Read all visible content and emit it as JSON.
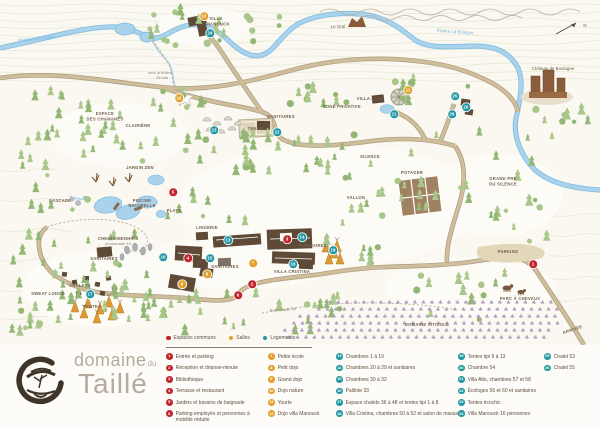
{
  "logo": {
    "name_top": "domaine",
    "name_top_small": "du",
    "name_bottom": "Taillé"
  },
  "colors": {
    "communs": "#c0272d",
    "salles": "#e2a12b",
    "logements": "#2097a3",
    "river": "#a9d3ec",
    "river_dark": "#7fbce0",
    "road": "#cfbd9c",
    "road_edge": "#ab9a7e",
    "tree_a": "#a9c78a",
    "tree_b": "#92b774",
    "building": "#5f4a38",
    "label": "#72614e",
    "water_label": "#79b7dc",
    "path_label": "#8d8273",
    "contour": "#e4ead4",
    "logo_text": "#b6ab9c",
    "logo_mark": "#3e3428",
    "vine": "#b29cc6"
  },
  "legend": {
    "key": [
      {
        "label": "Espaces communs",
        "cat": "communs"
      },
      {
        "label": "Salles",
        "cat": "salles"
      },
      {
        "label": "Logements",
        "cat": "logements"
      }
    ],
    "items": [
      {
        "n": 1,
        "col": 1,
        "cat": "communs",
        "label": "Entrée et parking"
      },
      {
        "n": 2,
        "col": 1,
        "cat": "communs",
        "label": "Réception et dépose-minute"
      },
      {
        "n": 3,
        "col": 1,
        "cat": "communs",
        "label": "Bibliothèque"
      },
      {
        "n": 4,
        "col": 1,
        "cat": "communs",
        "label": "Terrasse et restaurant"
      },
      {
        "n": 5,
        "col": 1,
        "cat": "communs",
        "label": "Jardins et bassins de baignade"
      },
      {
        "n": 6,
        "col": 1,
        "cat": "communs",
        "label": "Parking employés et personnes à mobilité réduite",
        "wrap": true
      },
      {
        "n": 7,
        "col": 2,
        "cat": "salles",
        "label": "Petite école"
      },
      {
        "n": 8,
        "col": 2,
        "cat": "salles",
        "label": "Petit dojo"
      },
      {
        "n": 9,
        "col": 2,
        "cat": "salles",
        "label": "Grand dojo"
      },
      {
        "n": 10,
        "col": 2,
        "cat": "salles",
        "label": "Dojo nature"
      },
      {
        "n": 11,
        "col": 2,
        "cat": "salles",
        "label": "Yourte"
      },
      {
        "n": 12,
        "col": 2,
        "cat": "salles",
        "label": "Dojo villa Manouck"
      },
      {
        "n": 13,
        "col": 3,
        "cat": "logements",
        "label": "Chambres 1 à 19"
      },
      {
        "n": 14,
        "col": 3,
        "cat": "logements",
        "label": "Chambres 20 à 29 et sanitaires"
      },
      {
        "n": 15,
        "col": 3,
        "cat": "logements",
        "label": "Chambres 30 à 32"
      },
      {
        "n": 16,
        "col": 3,
        "cat": "logements",
        "label": "Paillote 33"
      },
      {
        "n": 17,
        "col": 3,
        "cat": "logements",
        "label": "Espace chalets 36 à 48 et tentes tipi 1 à 8"
      },
      {
        "n": 18,
        "col": 3,
        "cat": "logements",
        "label": "Villa Cristina, chambres 50 à 52 et salon de massage"
      },
      {
        "n": 19,
        "col": 4,
        "cat": "logements",
        "label": "Tentes tipi 9 à 13"
      },
      {
        "n": 20,
        "col": 4,
        "cat": "logements",
        "label": "Chambre 54"
      },
      {
        "n": 21,
        "col": 4,
        "cat": "logements",
        "label": "Villa Alto, chambres 57 et 58"
      },
      {
        "n": 22,
        "col": 4,
        "cat": "logements",
        "label": "Écologes 56 et 60 et sanitaires"
      },
      {
        "n": 23,
        "col": 4,
        "cat": "logements",
        "label": "Tentes écochic"
      },
      {
        "n": 24,
        "col": 4,
        "cat": "logements",
        "label": "Villa Manouck 16 personnes"
      },
      {
        "n": 25,
        "col": 5,
        "cat": "logements",
        "label": "Chalet 53"
      },
      {
        "n": 26,
        "col": 5,
        "cat": "logements",
        "label": "Chalet 55"
      }
    ]
  },
  "map": {
    "markers": [
      {
        "n": 1,
        "x": 533,
        "y": 264
      },
      {
        "n": 2,
        "x": 252,
        "y": 284
      },
      {
        "n": 3,
        "x": 287,
        "y": 239
      },
      {
        "n": 4,
        "x": 188,
        "y": 258
      },
      {
        "n": 5,
        "x": 173,
        "y": 192
      },
      {
        "n": 6,
        "x": 238,
        "y": 295
      },
      {
        "n": 7,
        "x": 253,
        "y": 263
      },
      {
        "n": 8,
        "x": 207,
        "y": 274
      },
      {
        "n": 9,
        "x": 182,
        "y": 284
      },
      {
        "n": 10,
        "x": 179,
        "y": 98
      },
      {
        "n": 11,
        "x": 408,
        "y": 90
      },
      {
        "n": 12,
        "x": 204,
        "y": 16
      },
      {
        "n": 13,
        "x": 228,
        "y": 240
      },
      {
        "n": 14,
        "x": 302,
        "y": 237
      },
      {
        "n": 15,
        "x": 210,
        "y": 258
      },
      {
        "n": 16,
        "x": 163,
        "y": 257
      },
      {
        "n": 17,
        "x": 90,
        "y": 294
      },
      {
        "n": 18,
        "x": 293,
        "y": 264
      },
      {
        "n": 19,
        "x": 333,
        "y": 250
      },
      {
        "n": 20,
        "x": 466,
        "y": 107
      },
      {
        "n": 21,
        "x": 394,
        "y": 114
      },
      {
        "n": 22,
        "x": 277,
        "y": 132
      },
      {
        "n": 23,
        "x": 214,
        "y": 130
      },
      {
        "n": 24,
        "x": 210,
        "y": 33
      },
      {
        "n": 25,
        "x": 455,
        "y": 96
      },
      {
        "n": 26,
        "x": 452,
        "y": 114
      }
    ],
    "labels": [
      {
        "t": "Rivière La Bologne",
        "x": 37,
        "y": 40,
        "k": "w",
        "r": -6
      },
      {
        "t": "Rivière La Bologne",
        "x": 455,
        "y": 33,
        "k": "w",
        "r": 4
      },
      {
        "t": "Le Gral",
        "x": 338,
        "y": 28,
        "k": "s"
      },
      {
        "t": "Château de Boulogne",
        "x": 553,
        "y": 70,
        "k": "s"
      },
      {
        "t": "N",
        "x": 585,
        "y": 27,
        "k": "s"
      },
      {
        "t": "vers la rivière",
        "x": 160,
        "y": 74,
        "k": "p"
      },
      {
        "t": "25 min",
        "x": 162,
        "y": 79,
        "k": "p"
      },
      {
        "t": "VILLA",
        "x": 216,
        "y": 20,
        "k": "b"
      },
      {
        "t": "MANOUCK",
        "x": 218,
        "y": 25.5,
        "k": "b"
      },
      {
        "t": "ESPACE",
        "x": 105,
        "y": 115,
        "k": "b"
      },
      {
        "t": "DES CHAMANES",
        "x": 105,
        "y": 120.5,
        "k": "b"
      },
      {
        "t": "CLAIRIÈRE",
        "x": 138,
        "y": 127,
        "k": "b"
      },
      {
        "t": "TENNIS",
        "x": 256,
        "y": 130,
        "k": "b"
      },
      {
        "t": "SANITAIRES",
        "x": 281,
        "y": 118,
        "k": "b"
      },
      {
        "t": "ZONE PRIVATIVE",
        "x": 342,
        "y": 108,
        "k": "b"
      },
      {
        "t": "VILLA ALTO",
        "x": 370,
        "y": 100,
        "k": "b"
      },
      {
        "t": "SILENCE",
        "x": 370,
        "y": 158,
        "k": "b"
      },
      {
        "t": "POTAGER",
        "x": 412,
        "y": 174,
        "k": "b"
      },
      {
        "t": "VALLON",
        "x": 356,
        "y": 199,
        "k": "b"
      },
      {
        "t": "GRAND PRÉ",
        "x": 503,
        "y": 180,
        "k": "b"
      },
      {
        "t": "DU SILENCE",
        "x": 503,
        "y": 185.5,
        "k": "b"
      },
      {
        "t": "JARDIN ZEN",
        "x": 140,
        "y": 169,
        "k": "b"
      },
      {
        "t": "CASCADE",
        "x": 60,
        "y": 202,
        "k": "b"
      },
      {
        "t": "PISCINE",
        "x": 142,
        "y": 202,
        "k": "b"
      },
      {
        "t": "NATURELLE",
        "x": 142,
        "y": 207,
        "k": "b"
      },
      {
        "t": "PLATS",
        "x": 174,
        "y": 212,
        "k": "b"
      },
      {
        "t": "CHEMIN MENHIRS",
        "x": 118,
        "y": 240,
        "k": "b"
      },
      {
        "t": "promenade 1h",
        "x": 118,
        "y": 245,
        "k": "p"
      },
      {
        "t": "SANITAIRES",
        "x": 104,
        "y": 260,
        "k": "b"
      },
      {
        "t": "CHALETS",
        "x": 80,
        "y": 287,
        "k": "b"
      },
      {
        "t": "SWEAT LODGE",
        "x": 48,
        "y": 295,
        "k": "b"
      },
      {
        "t": "TENTES",
        "x": 92,
        "y": 308,
        "k": "b"
      },
      {
        "t": "LINGERIE",
        "x": 207,
        "y": 229,
        "k": "b"
      },
      {
        "t": "SANITAIRES",
        "x": 225,
        "y": 268,
        "k": "b"
      },
      {
        "t": "VILLA CRISTINA",
        "x": 292,
        "y": 273,
        "k": "b"
      },
      {
        "t": "SANITAIRES",
        "x": 313,
        "y": 247,
        "k": "b"
      },
      {
        "t": "PARKING",
        "x": 508,
        "y": 253,
        "k": "b"
      },
      {
        "t": "PARC À CHEVAUX",
        "x": 520,
        "y": 300,
        "k": "b"
      },
      {
        "t": "DOMAINE VITICOLE",
        "x": 427,
        "y": 326,
        "k": "b"
      },
      {
        "t": "ARRIVÉE",
        "x": 573,
        "y": 331,
        "k": "b",
        "r": -18
      },
      {
        "t": "Promenade 5h",
        "x": 283,
        "y": 311,
        "k": "p",
        "r": -4
      }
    ]
  }
}
